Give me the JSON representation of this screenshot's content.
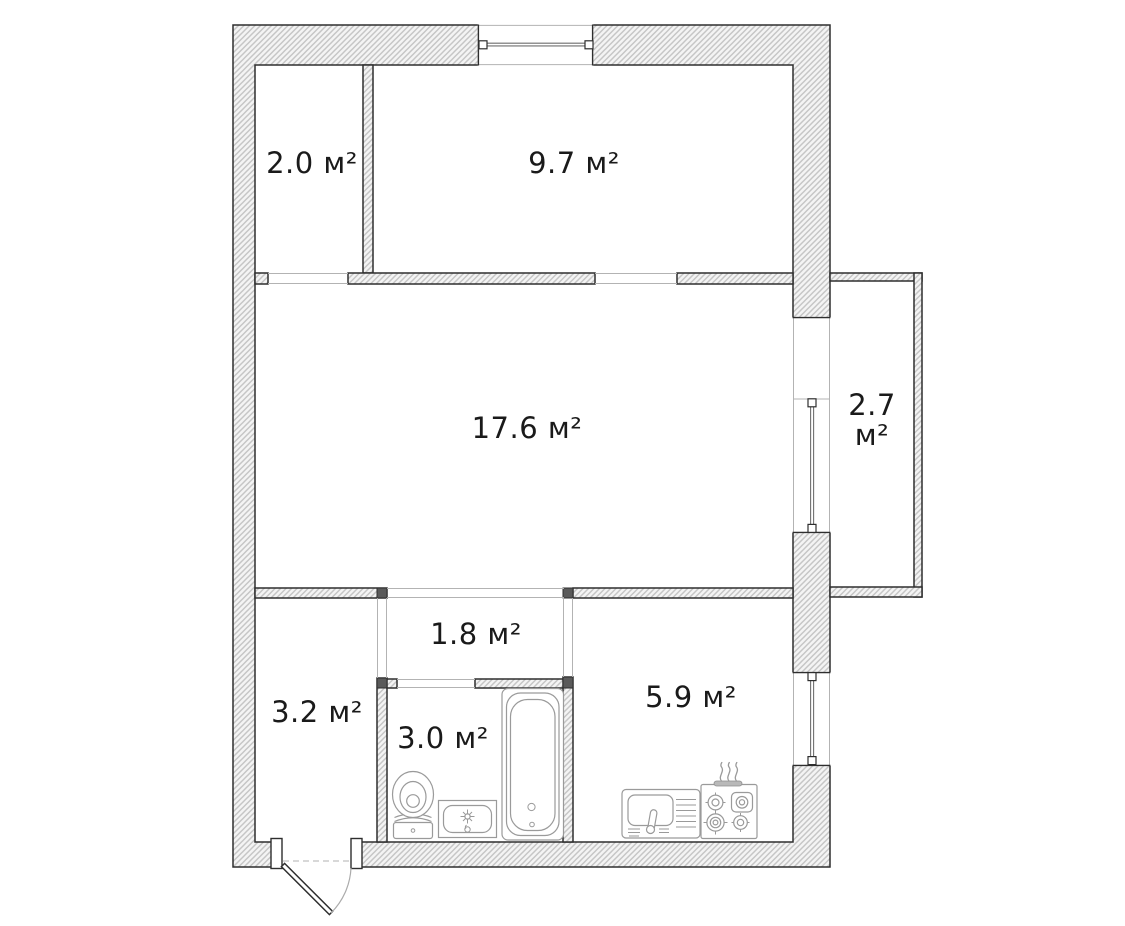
{
  "plan": {
    "rooms": [
      {
        "id": "storage",
        "label": "2.0 м²"
      },
      {
        "id": "bedroom",
        "label": "9.7 м²"
      },
      {
        "id": "living-room",
        "label": "17.6 м²"
      },
      {
        "id": "balcony",
        "label": "2.7 м²"
      },
      {
        "id": "hallway",
        "label": "3.2 м²"
      },
      {
        "id": "corridor",
        "label": "1.8 м²"
      },
      {
        "id": "bathroom",
        "label": "3.0 м²"
      },
      {
        "id": "kitchen",
        "label": "5.9 м²"
      }
    ],
    "fixtures": [
      "toilet",
      "bathroom-sink",
      "bathtub",
      "kitchen-sink",
      "stove",
      "entrance-door",
      "top-window",
      "balcony-window",
      "kitchen-window",
      "balcony-door-opening"
    ]
  },
  "colors": {
    "background": "#ffffff",
    "wall_outline": "#2e2e2e",
    "wall_hatch_line": "#c6c6c6",
    "wall_hatch_bg": "#f4f4f4",
    "junction_cap": "#5a5a5a",
    "fixture_line": "#9a9a9a",
    "opening_line": "#b3b3b3",
    "label_text": "#1a1a1a"
  }
}
